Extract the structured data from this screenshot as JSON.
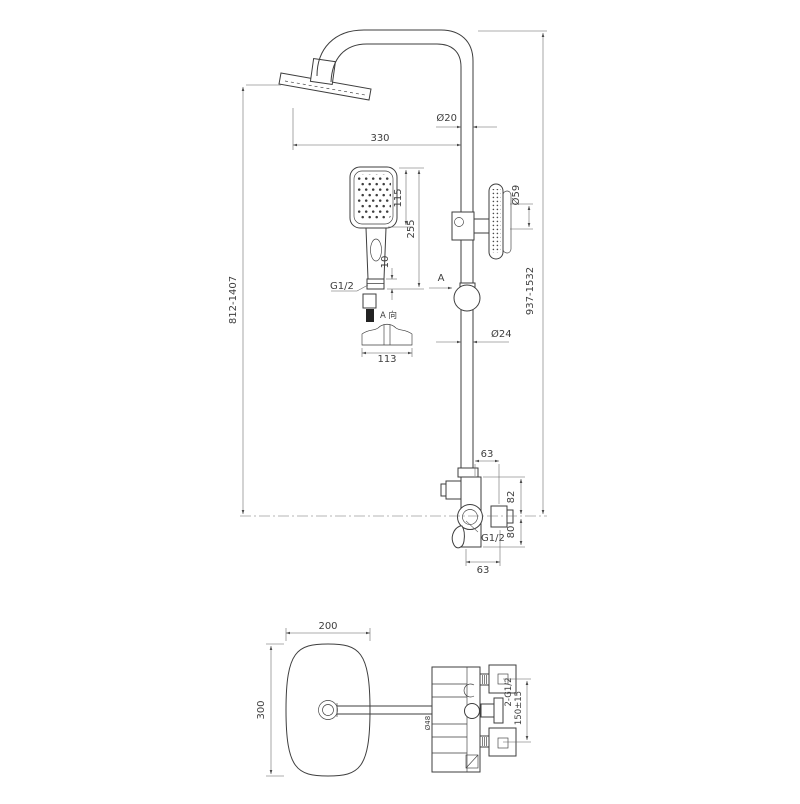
{
  "drawing": {
    "title": "shower-system-dimension-drawing",
    "background": "#ffffff",
    "line_color": "#3e3e3e",
    "dim_color": "#5f5f5f",
    "front_view": {
      "arm_length": "330",
      "arm_pipe_diameter": "Ø20",
      "handshower_head_length": "115",
      "handshower_total_length": "255",
      "handshower_connector_height": "10",
      "handshower_thread": "G1/2",
      "section_view_label": "A 向",
      "section_width": "113",
      "view_arrow_label": "A",
      "riser_pipe_diameter": "Ø24",
      "holder_diameter": "Ø59",
      "height_range_left": "812-1407",
      "height_range_right": "937-1532",
      "valve_top_offset": "63",
      "valve_upper_height": "82",
      "valve_lower_height": "80",
      "valve_outlet_thread": "G1/2",
      "valve_bottom_offset": "63"
    },
    "plan_view": {
      "head_width": "200",
      "head_depth": "300",
      "inlet_spec": "2-G1/2",
      "inlet_spacing": "150±15",
      "escutcheon_diameter": "Ø48"
    }
  }
}
